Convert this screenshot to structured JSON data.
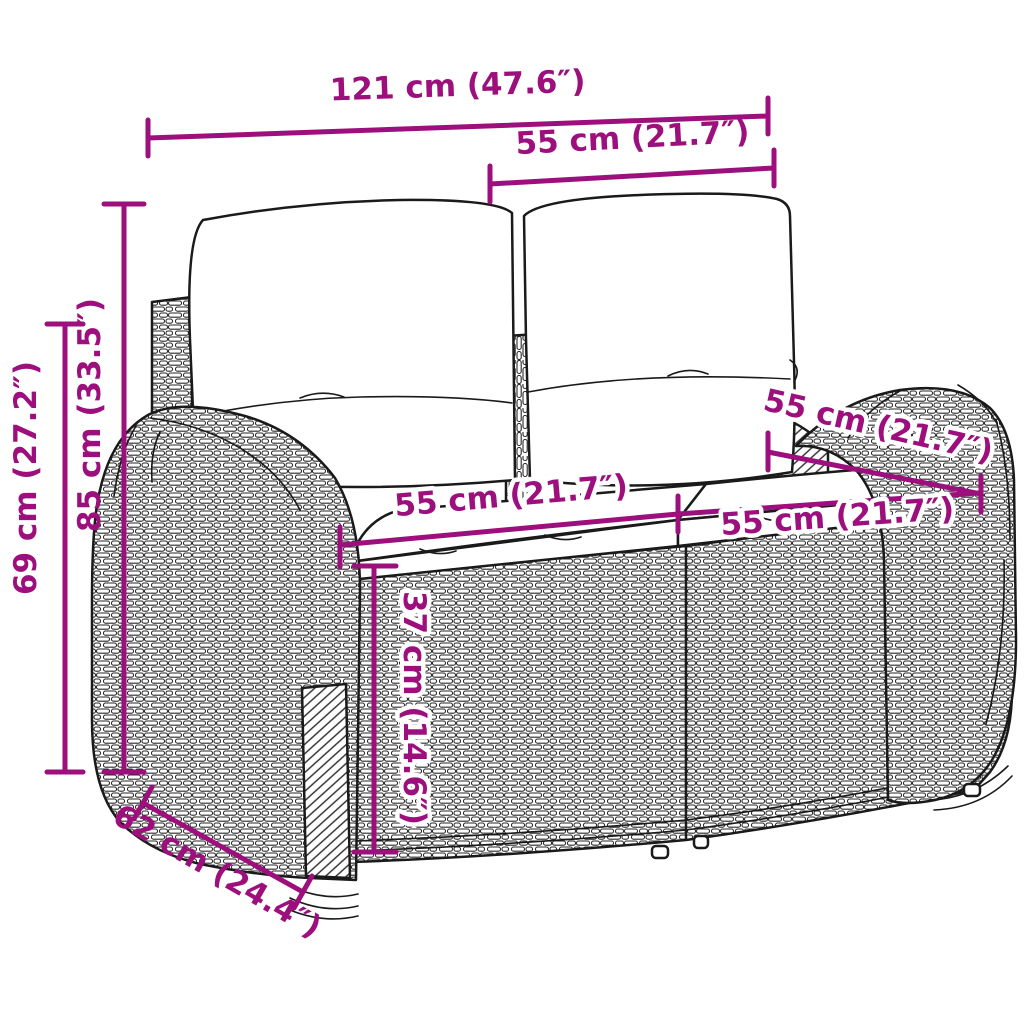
{
  "diagram": {
    "subject": "rattan garden bench with cushions - dimension drawing",
    "colors": {
      "accent": "#9C0F7D",
      "line": "#1A1A1A",
      "background": "#FFFFFF"
    },
    "dimensions": {
      "width_total": {
        "label": "121 cm (47.6″)"
      },
      "width_backrest_cushion": {
        "label": "55 cm (21.7″)"
      },
      "height_total": {
        "label": "85 cm (33.5″)"
      },
      "height_frame": {
        "label": "69 cm (27.2″)"
      },
      "depth_seat": {
        "label": "55 cm (21.7″)"
      },
      "width_seat_left": {
        "label": "55 cm (21.7″)"
      },
      "width_seat_right": {
        "label": "55 cm (21.7″)"
      },
      "height_seat": {
        "label": "37 cm (14.6″)"
      },
      "depth_total": {
        "label": "62 cm (24.4″)"
      }
    }
  }
}
